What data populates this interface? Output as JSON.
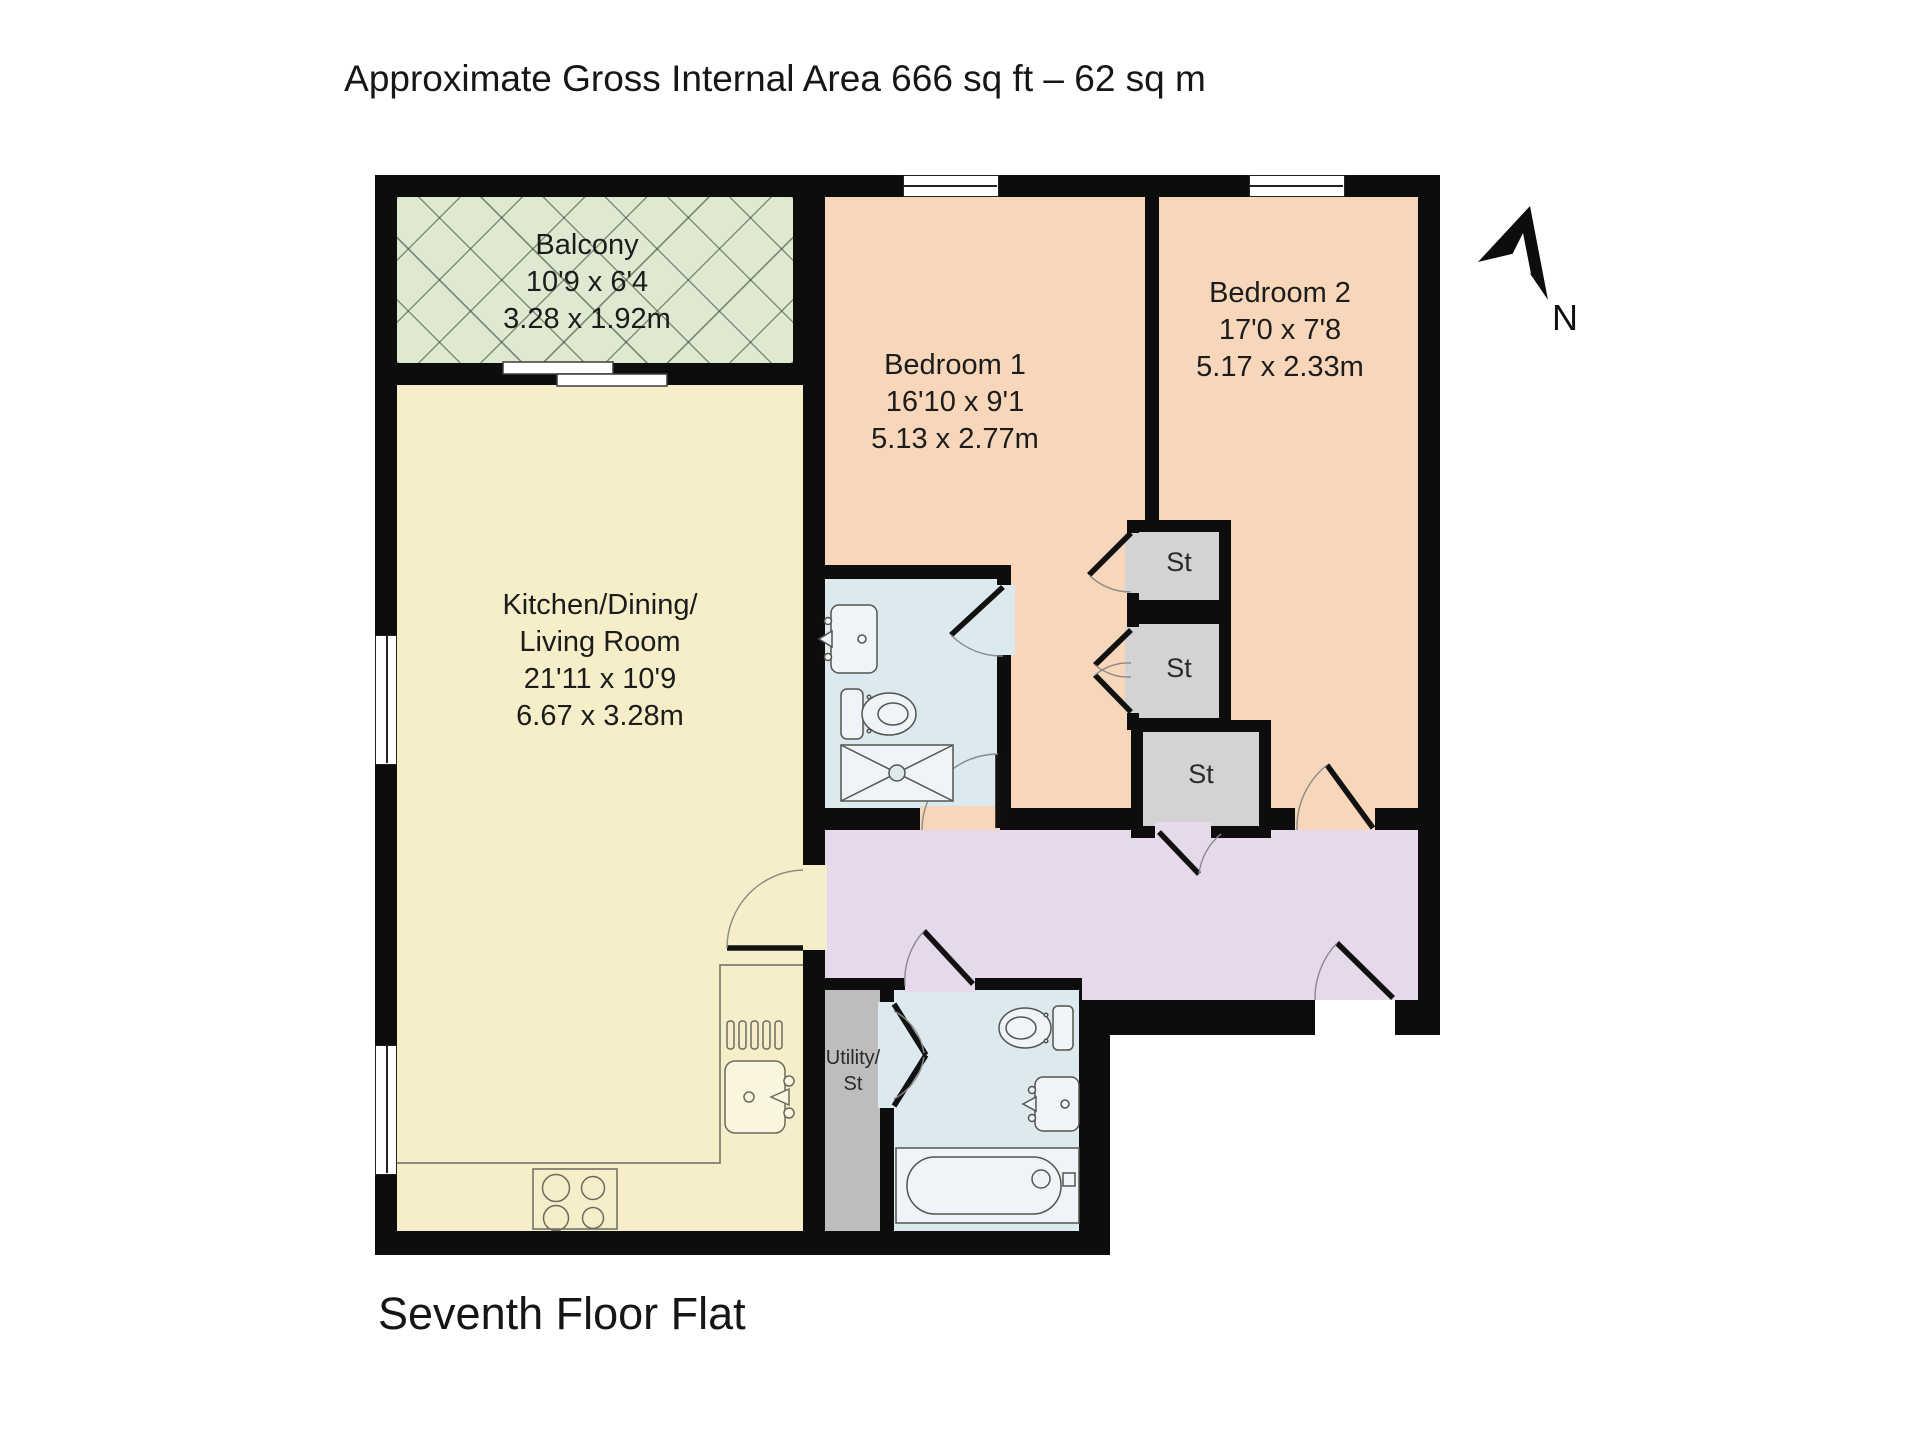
{
  "title": "Approximate Gross Internal Area 666 sq ft – 62 sq m",
  "floor_label": "Seventh Floor Flat",
  "compass_label": "N",
  "colors": {
    "walls": "#0d0d0d",
    "balcony": "#dfe9d2",
    "kitchen": "#f5eec9",
    "bedroom": "#f8d6ba",
    "bathroom": "#dce9ef",
    "hallway": "#e7d9ec",
    "storage": "#d3d3d3",
    "utility": "#bdbdbd"
  },
  "rooms": {
    "balcony": {
      "name": "Balcony",
      "imperial": "10'9 x 6'4",
      "metric": "3.28 x 1.92m"
    },
    "kitchen": {
      "line1": "Kitchen/Dining/",
      "line2": "Living Room",
      "imperial": "21'11 x 10'9",
      "metric": "6.67 x 3.28m"
    },
    "bedroom1": {
      "name": "Bedroom 1",
      "imperial": "16'10 x 9'1",
      "metric": "5.13 x 2.77m"
    },
    "bedroom2": {
      "name": "Bedroom 2",
      "imperial": "17'0 x 7'8",
      "metric": "5.17 x 2.33m"
    },
    "storage1": {
      "name": "St"
    },
    "storage2": {
      "name": "St"
    },
    "storage3": {
      "name": "St"
    },
    "utility": {
      "line1": "Utility/",
      "line2": "St"
    }
  }
}
